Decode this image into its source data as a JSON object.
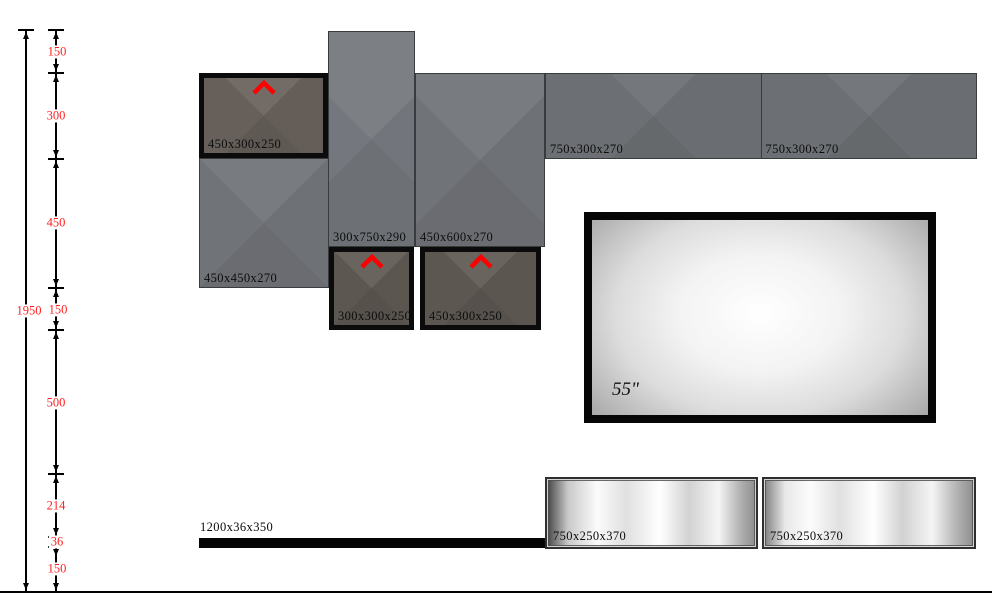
{
  "dimensions": {
    "total": "1950",
    "segments": [
      "150",
      "300",
      "450",
      "150",
      "500",
      "214",
      "36",
      "150"
    ]
  },
  "units": {
    "top_door": "450x300x250",
    "tall_cabinet": "300x750x290",
    "square_cabinet": "450x450x270",
    "mid_cabinet": "450x600x270",
    "top_shelves": [
      "750x300x270",
      "750x300x270"
    ],
    "small_door": "300x300x250",
    "wide_door": "450x300x250",
    "tv_size": "55\"",
    "plinth": "1200x36x350",
    "bottom_shelves": [
      "750x250x370",
      "750x250x370"
    ]
  },
  "colors": {
    "dimension_text": "#ff2020",
    "door_arrow": "#ff0000",
    "cabinet_gray": "#72757a",
    "door_gray": "#6a635d"
  }
}
